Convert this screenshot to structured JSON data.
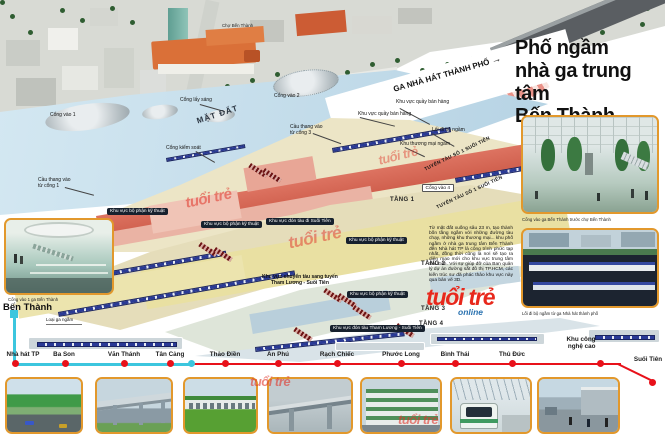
{
  "masthead": {
    "brand": "tuổi trẻ",
    "brand_sub": "online"
  },
  "title": {
    "line1": "Phố ngầm",
    "line2": "nhà ga trung tâm",
    "line3": "Bến Thành"
  },
  "intro": "Từ mặt đất xuống sâu 23 m, tạo thành bốn tầng ngầm với những đường tàu chạy, những khu thương mại... khu phố ngầm ở nhà ga trung tâm Bến Thành đến Nhà hát TP là công trình phức tạp nhất, đồng thời cũng là nơi sẽ tạo ra diện mạo mới cho khu vực trung tâm Sài Gòn. Với sự giúp đỡ của Ban quản lý dự án đường sắt đô thị TP.HCM, các kiến trúc sư đã phác thảo khu vực này qua bản vẽ 3D.",
  "illustration": {
    "street": "LÊ LỢI",
    "market": "Chợ Bến Thành",
    "ground": "MẶT ĐẤT",
    "theater_direction": "GA NHÀ HÁT THÀNH PHỐ",
    "theater_arrow": "→",
    "line1_track": "TUYẾN TÀU SỐ 1 SUỐI TIÊN",
    "skylight": "Cổng lấy sáng",
    "gate1": "Cổng vào 1",
    "gate2": "Cổng vào 2",
    "gate4": "Cổng vào 4",
    "stairs_gate1": "Cầu thang vào\ntừ cổng 1",
    "stairs_gate3": "Cầu thang vào\ntừ cổng 3",
    "control_gate": "Cổng kiểm soát",
    "kiosk_area": "Khu vực quầy bán hàng",
    "walkway": "Lối đi bộ ngầm",
    "mall": "Khu thương mại ngầm",
    "tech_area": "Khu vực bộ phận kỹ thuật",
    "board_suoitien": "Khu vực đón tàu đi Suối Tiên",
    "transfer": "Khu vực chuyển tàu sang tuyến\nTham Lương - Suối Tiên",
    "board_thamluong": "Khu vực đón tàu Tham Lương - Suối Tiên",
    "level1": "TẦNG 1",
    "level2": "TẦNG 2",
    "level3": "TẦNG 3",
    "level4": "TẦNG 4"
  },
  "insets": {
    "left_caption": "Cổng vào 1 ga Bến Thành",
    "right_top_caption": "Cổng vào ga Bến Thành trước chợ Bến Thành",
    "right_bottom_caption": "Lối đi bộ ngầm từ ga Nhà hát thành phố"
  },
  "metro_map": {
    "terminal": "Bến Thành",
    "terminal_type": "Loại ga ngầm",
    "stations": [
      "Nhà hát TP",
      "Ba Son",
      "Văn Thánh",
      "Tân Cảng",
      "Thảo Điền",
      "An Phú",
      "Rạch Chiếc",
      "Phước Long",
      "Bình Thái",
      "Thủ Đức",
      "Khu công\nnghệ cao",
      "Suối Tiên"
    ],
    "colors": {
      "line": "#e8111a",
      "underground": "#3cc6de",
      "photo_border": "#e2982c"
    }
  }
}
